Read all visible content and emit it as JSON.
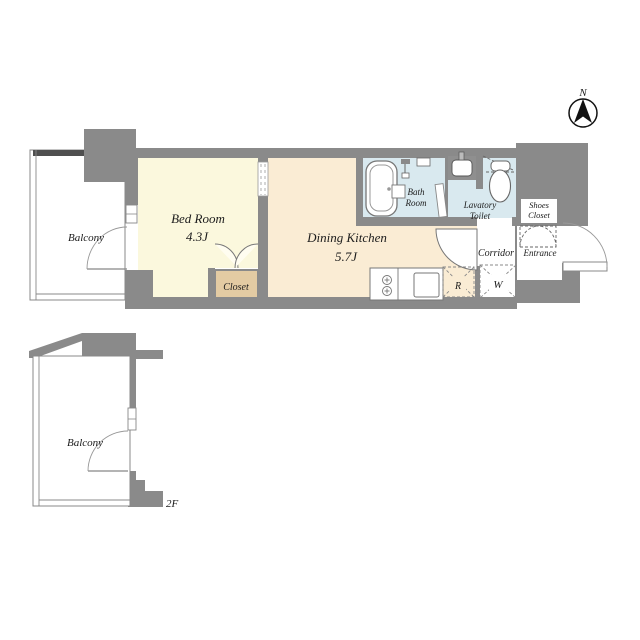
{
  "compass": {
    "north_label": "N"
  },
  "floor1": {
    "balcony": "Balcony",
    "bedroom_name": "Bed Room",
    "bedroom_size": "4.3J",
    "dining_name": "Dining Kitchen",
    "dining_size": "5.7J",
    "closet": "Closet",
    "bath_line1": "Bath",
    "bath_line2": "Room",
    "lavatory_line1": "Lavatory",
    "lavatory_line2": "Toilet",
    "corridor": "Corridor",
    "entrance": "Entrance",
    "shoes_line1": "Shoes",
    "shoes_line2": "Closet",
    "refrigerator_mark": "R",
    "washer_mark": "W"
  },
  "floor2": {
    "balcony": "Balcony",
    "floor_label": "2F"
  },
  "colors": {
    "wall": "#8a8a8a",
    "wall_dark": "#4f4f4f",
    "bedroom": "#fbf8dd",
    "dining": "#faecd4",
    "closet": "#e3cba3",
    "wet_area": "#d9e9ef",
    "outline": "#888888",
    "fixture": "#777777",
    "ink": "#111111"
  }
}
